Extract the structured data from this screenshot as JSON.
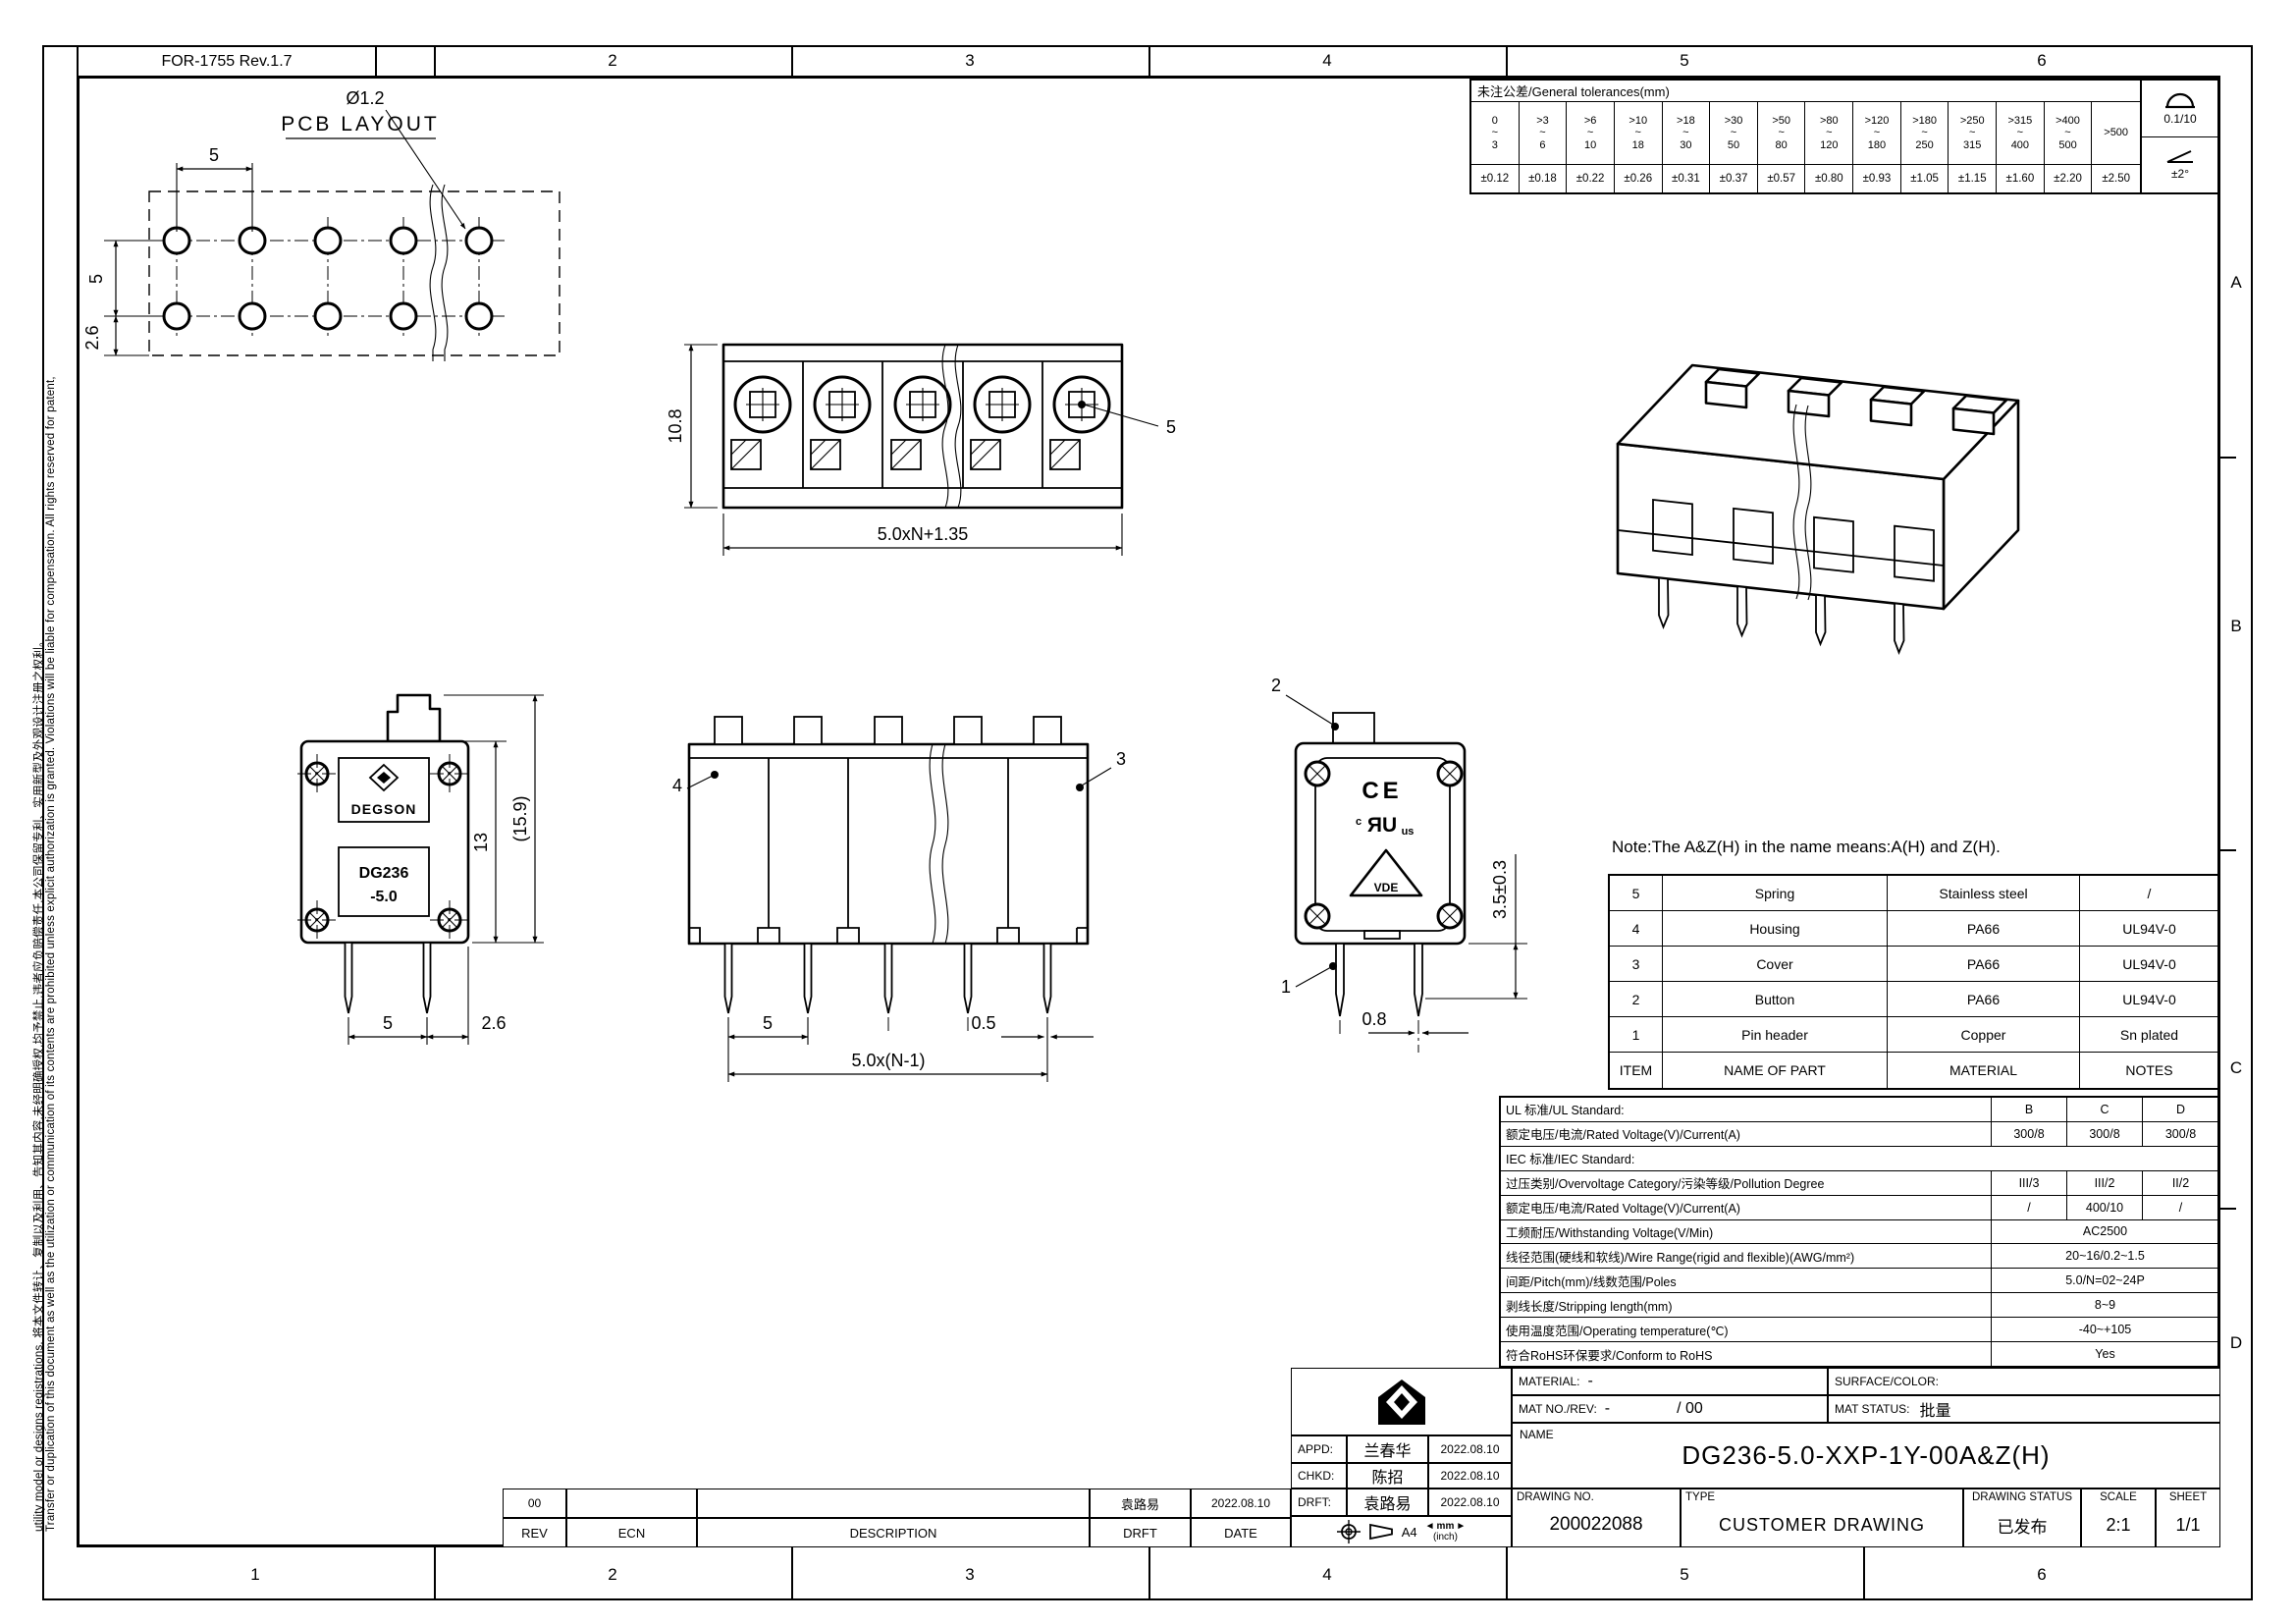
{
  "frame": {
    "form_no": "FOR-1755 Rev.1.7",
    "zones_top": [
      "2",
      "3",
      "4",
      "5",
      "6"
    ],
    "zones_bottom": [
      "1",
      "2",
      "3",
      "4",
      "5",
      "6"
    ],
    "zones_right": [
      "A",
      "B",
      "C",
      "D"
    ]
  },
  "margin_note": {
    "en": "Transfer or duplication of this document as well as the utilization or communication of its contents are prohibited unless explicit authorization is granted. Violations will be liable for compensation. All rights reserved for patent,",
    "cn": "utility model or designs registrations. 将本文件转让、复制以及利用、告知其内容,未经明确授权,均予禁止,违者应负赔偿责任,本公司保留专利、实用新型及外观设计注册之权利。"
  },
  "tolerance_table": {
    "title": "未注公差/General tolerances(mm)",
    "cols": [
      {
        "range": "0\n~\n3",
        "tol": "±0.12"
      },
      {
        "range": ">3\n~\n6",
        "tol": "±0.18"
      },
      {
        "range": ">6\n~\n10",
        "tol": "±0.22"
      },
      {
        "range": ">10\n~\n18",
        "tol": "±0.26"
      },
      {
        "range": ">18\n~\n30",
        "tol": "±0.31"
      },
      {
        "range": ">30\n~\n50",
        "tol": "±0.37"
      },
      {
        "range": ">50\n~\n80",
        "tol": "±0.57"
      },
      {
        "range": ">80\n~\n120",
        "tol": "±0.80"
      },
      {
        "range": ">120\n~\n180",
        "tol": "±0.93"
      },
      {
        "range": ">180\n~\n250",
        "tol": "±1.05"
      },
      {
        "range": ">250\n~\n315",
        "tol": "±1.15"
      },
      {
        "range": ">315\n~\n400",
        "tol": "±1.60"
      },
      {
        "range": ">400\n~\n500",
        "tol": "±2.20"
      },
      {
        "range": ">500",
        "tol": "±2.50"
      }
    ],
    "flatness": "0.1/10",
    "angle": "±2°"
  },
  "views": {
    "pcb": {
      "title": "PCB LAYOUT",
      "dim_pitch": "5",
      "dim_row": "5",
      "dim_edge": "2.6",
      "hole_dia": "Ø1.2"
    },
    "front": {
      "dim_height": "10.8",
      "dim_width": "5.0xN+1.35",
      "leader_spring": "5"
    },
    "side": {
      "brand": "DEGSON",
      "marking_line1": "DG236",
      "marking_line2": "-5.0",
      "dim_body": "13",
      "dim_overall": "(15.9)",
      "dim_pitch": "5",
      "dim_edge": "2.6"
    },
    "rear": {
      "leader_housing": "4",
      "leader_cover": "3",
      "dim_pitch": "5",
      "dim_span": "5.0x(N-1)",
      "dim_pin_w": "0.5"
    },
    "back": {
      "leader_button": "2",
      "leader_pin": "1",
      "dim_pin_len": "3.5±0.3",
      "dim_pin_w": "0.8",
      "mark_ce": "CE",
      "mark_ul_left": "c",
      "mark_ul": "ЯU",
      "mark_ul_right": "us",
      "mark_vde": "VDE"
    },
    "note": "Note:The A&Z(H) in the name means:A(H) and Z(H)."
  },
  "bom_table": {
    "headers": {
      "item": "ITEM",
      "name": "NAME OF PART",
      "material": "MATERIAL",
      "notes": "NOTES"
    },
    "rows": [
      {
        "item": "5",
        "name": "Spring",
        "material": "Stainless steel",
        "notes": "/"
      },
      {
        "item": "4",
        "name": "Housing",
        "material": "PA66",
        "notes": "UL94V-0"
      },
      {
        "item": "3",
        "name": "Cover",
        "material": "PA66",
        "notes": "UL94V-0"
      },
      {
        "item": "2",
        "name": "Button",
        "material": "PA66",
        "notes": "UL94V-0"
      },
      {
        "item": "1",
        "name": "Pin header",
        "material": "Copper",
        "notes": "Sn plated"
      }
    ]
  },
  "spec_table": {
    "rows": [
      {
        "label": "UL 标准/UL Standard:",
        "b": "B",
        "c": "C",
        "d": "D"
      },
      {
        "label": "额定电压/电流/Rated Voltage(V)/Current(A)",
        "b": "300/8",
        "c": "300/8",
        "d": "300/8"
      },
      {
        "label": "IEC 标准/IEC Standard:"
      },
      {
        "label": "过压类别/Overvoltage Category/污染等级/Pollution Degree",
        "b": "III/3",
        "c": "III/2",
        "d": "II/2"
      },
      {
        "label": "额定电压/电流/Rated Voltage(V)/Current(A)",
        "b": "/",
        "c": "400/10",
        "d": "/"
      },
      {
        "label": "工频耐压/Withstanding Voltage(V/Min)",
        "span": "AC2500"
      },
      {
        "label": "线径范围(硬线和软线)/Wire Range(rigid and flexible)(AWG/mm²)",
        "span": "20~16/0.2~1.5"
      },
      {
        "label": "间距/Pitch(mm)/线数范围/Poles",
        "span": "5.0/N=02~24P"
      },
      {
        "label": "剥线长度/Stripping length(mm)",
        "span": "8~9"
      },
      {
        "label": "使用温度范围/Operating temperature(℃)",
        "span": "-40~+105"
      },
      {
        "label": "符合RoHS环保要求/Conform to RoHS",
        "span": "Yes"
      }
    ]
  },
  "title_block": {
    "material_label": "MATERIAL:",
    "material_value": "-",
    "surface_label": "SURFACE/COLOR:",
    "matno_label": "MAT NO./REV:",
    "matno_value": "-",
    "matno_rev": "/ 00",
    "matstatus_label": "MAT STATUS:",
    "matstatus_value": "批量",
    "appd_label": "APPD:",
    "appd_name": "兰春华",
    "appd_date": "2022.08.10",
    "chkd_label": "CHKD:",
    "chkd_name": "陈招",
    "chkd_date": "2022.08.10",
    "drft_label": "DRFT:",
    "drft_name": "袁路易",
    "drft_date": "2022.08.10",
    "paper_size": "A4",
    "unit_primary": "mm",
    "unit_secondary": "(inch)",
    "name_label": "NAME",
    "part_name": "DG236-5.0-XXP-1Y-00A&Z(H)",
    "drawing_no_label": "DRAWING NO.",
    "drawing_no": "200022088",
    "type_label": "TYPE",
    "type_value": "CUSTOMER DRAWING",
    "status_label": "DRAWING STATUS",
    "status_value": "已发布",
    "scale_label": "SCALE",
    "scale_value": "2:1",
    "sheet_label": "SHEET",
    "sheet_value": "1/1"
  },
  "revision_table": {
    "rev_value": "00",
    "ecn_value": "",
    "desc_value": "",
    "drft_value": "袁路易",
    "date_value": "2022.08.10",
    "rev_label": "REV",
    "ecn_label": "ECN",
    "desc_label": "DESCRIPTION",
    "drft_label": "DRFT",
    "date_label": "DATE"
  }
}
